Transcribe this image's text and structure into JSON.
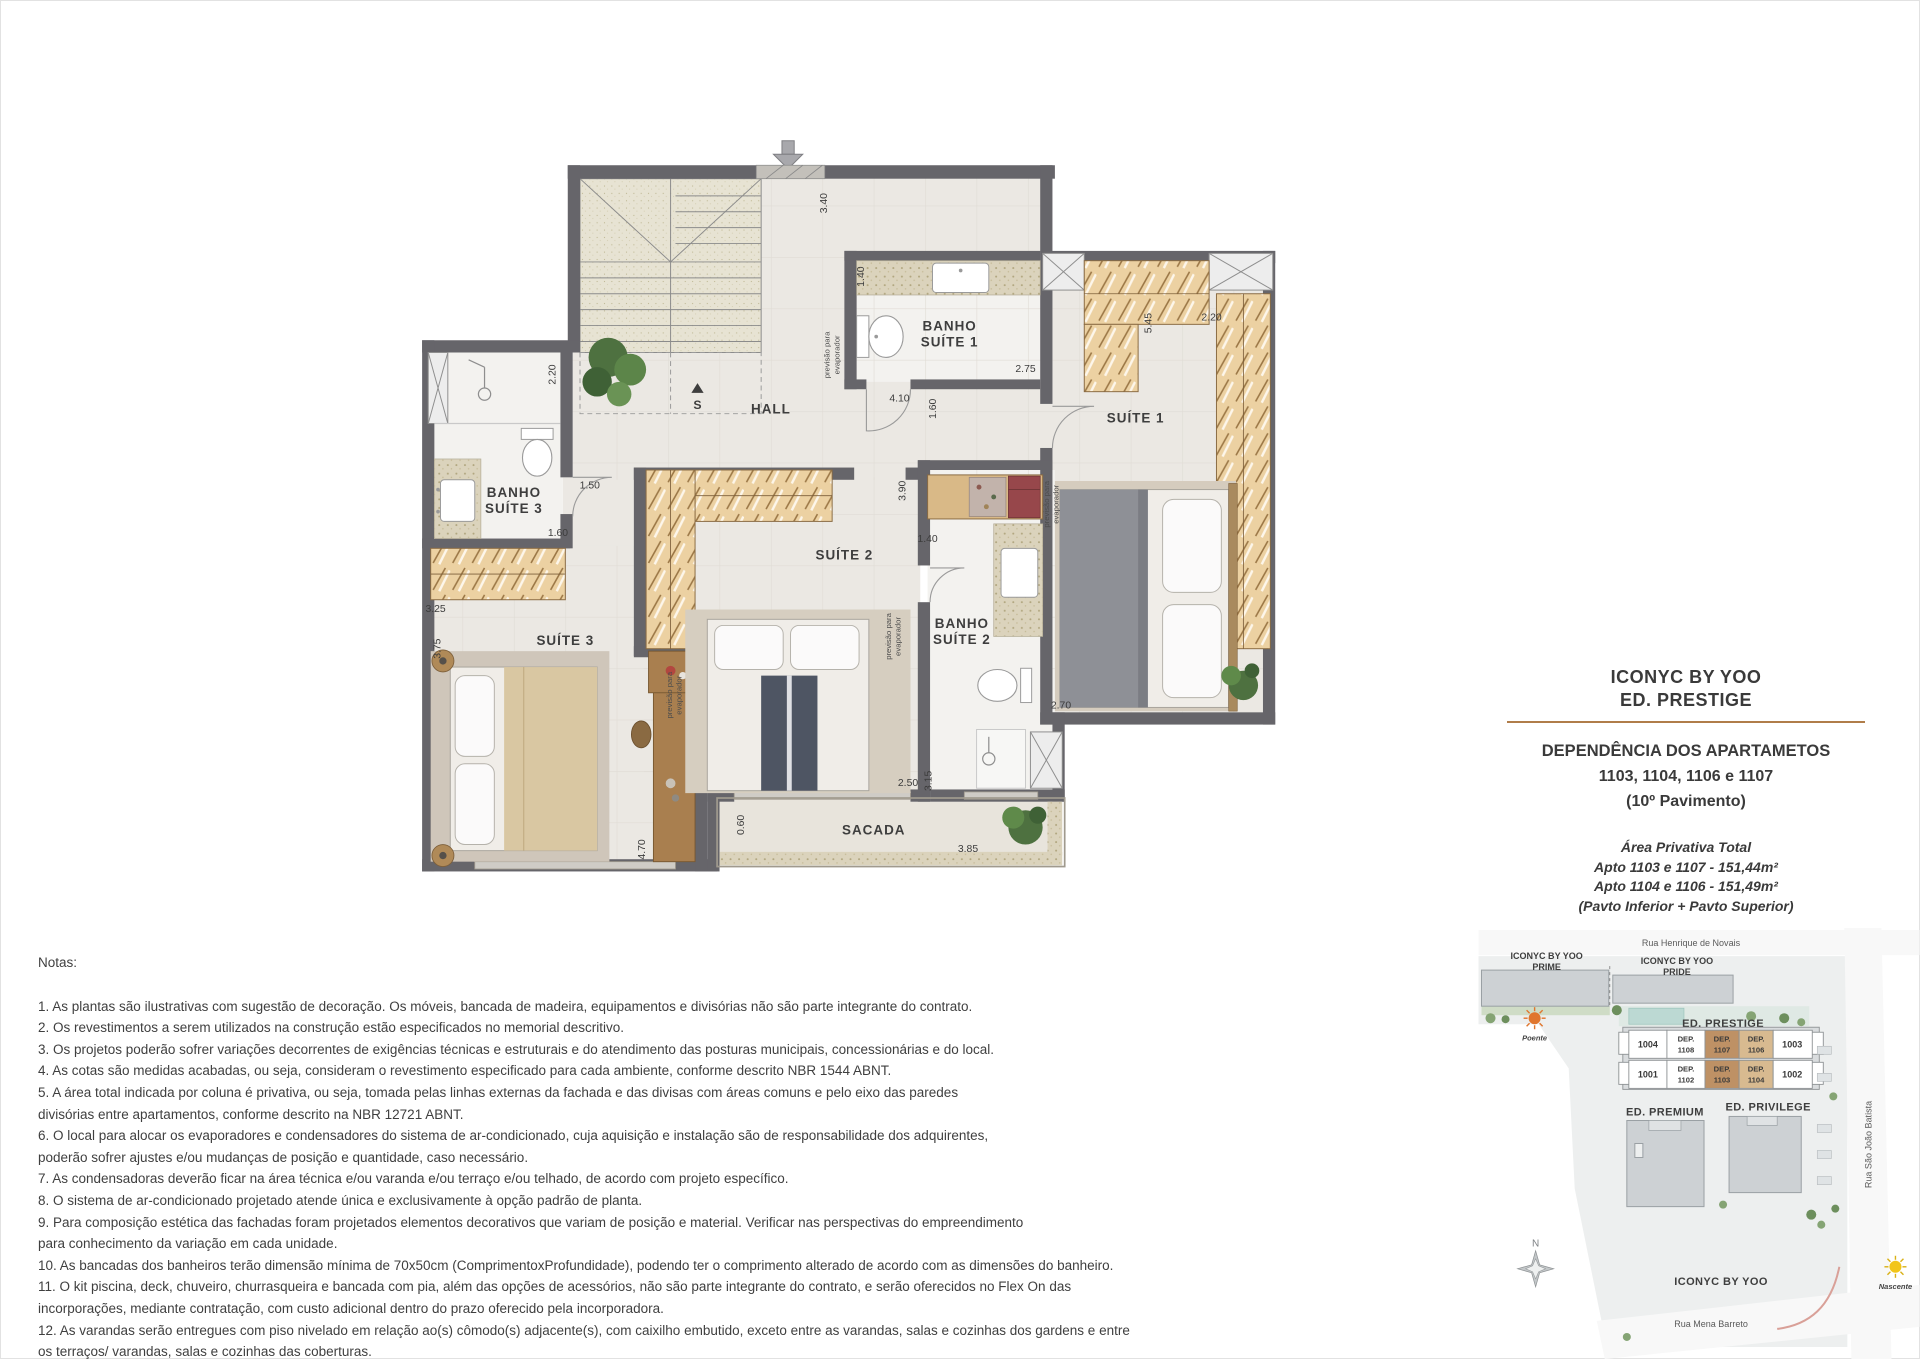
{
  "plan": {
    "rooms": {
      "hall": "HALL",
      "banho1_l1": "BANHO",
      "banho1_l2": "SUÍTE 1",
      "suite1": "SUÍTE 1",
      "banho3_l1": "BANHO",
      "banho3_l2": "SUÍTE 3",
      "suite2": "SUÍTE 2",
      "banho2_l1": "BANHO",
      "banho2_l2": "SUÍTE 2",
      "suite3": "SUÍTE 3",
      "sacada": "SACADA"
    },
    "dims": {
      "hall_340": "3.40",
      "b1_140": "1.40",
      "b1_275": "2.75",
      "s1_545": "5.45",
      "s1_220": "2.20",
      "hall_410": "4.10",
      "hall_160": "1.60",
      "b3_220": "2.20",
      "b3_150": "1.50",
      "b3_160": "1.60",
      "s3_325": "3.25",
      "s3_375": "3.75",
      "s3_470": "4.70",
      "s2_390": "3.90",
      "s2_140": "1.40",
      "s2_250": "2.50",
      "b2_270": "2.70",
      "b2_315": "3.15",
      "sac_060": "0.60",
      "sac_385": "3.85"
    },
    "stairs_marker": "S",
    "evap_l1": "previsão para",
    "evap_l2": "evaporador"
  },
  "title_block": {
    "line1": "ICONYC BY YOO",
    "line2": "ED. PRESTIGE",
    "heading1": "DEPENDÊNCIA DOS APARTAMETOS",
    "heading2": "1103, 1104, 1106 e 1107",
    "heading3": "(10º Pavimento)",
    "area_title": "Área Privativa Total",
    "area_line1": "Apto 1103 e 1107 - 151,44m²",
    "area_line2": "Apto 1104 e 1106 - 151,49m²",
    "area_line3": "(Pavto Inferior + Pavto Superior)"
  },
  "notes": {
    "title": "Notas:",
    "items": [
      "1. As plantas são ilustrativas com sugestão de decoração. Os móveis, bancada de madeira, equipamentos e divisórias não são parte integrante do contrato.",
      "2. Os revestimentos a serem utilizados na construção estão especificados no memorial descritivo.",
      "3. Os projetos poderão sofrer variações decorrentes de exigências técnicas e estruturais e do atendimento das posturas municipais, concessionárias e do local.",
      "4. As cotas são medidas acabadas, ou seja, consideram o revestimento especificado para cada ambiente, conforme descrito NBR 1544 ABNT.",
      "5. A área total indicada por coluna é privativa, ou seja, tomada pelas linhas externas da fachada e das divisas com áreas comuns e pelo eixo das paredes\ndivisórias entre apartamentos, conforme descrito na NBR 12721 ABNT.",
      "6. O local para alocar os evaporadores e condensadores do sistema de ar-condicionado, cuja aquisição e instalação são de responsabilidade dos adquirentes,\npoderão sofrer ajustes e/ou mudanças de posição e quantidade, caso necessário.",
      "7. As condensadoras deverão ficar na área técnica e/ou varanda e/ou terraço e/ou telhado, de acordo com projeto específico.",
      "8. O sistema de ar-condicionado projetado atende única e exclusivamente à opção padrão de planta.",
      "9. Para composição estética das fachadas foram projetados elementos decorativos que variam de posição e material. Verificar nas perspectivas do empreendimento\npara conhecimento da variação em cada unidade.",
      "10. As bancadas dos banheiros terão dimensão mínima de 70x50cm (ComprimentoxProfundidade), podendo ter o comprimento alterado de acordo com as dimensões do banheiro.",
      "11. O kit piscina, deck, chuveiro, churrasqueira e bancada com pia, além das opções de acessórios, não são parte integrante do contrato, e serão oferecidos no Flex On das\nincorporações, mediante contratação, com custo adicional dentro do prazo oferecido pela incorporadora.",
      "12. As varandas serão entregues com piso nivelado em relação ao(s) cômodo(s) adjacente(s), com caixilho embutido, exceto entre as varandas, salas e cozinhas dos gardens e entre\nos  terraços/ varandas, salas e cozinhas das coberturas."
    ],
    "footer": "A presente planta ilustra referencialmente a dependência dos apartamentos 1103 e 1106 do Ed. Prestige do Iconyc by Yoo, sendo a dependência dos apartamentos1104 e\n1107 do Ed. Prestige do Iconyc by Yoo espelhadas."
  },
  "site_plan": {
    "streets": {
      "north": "Rua Henrique de Novais",
      "east": "Rua São João Batista",
      "south": "Rua Mena Barreto"
    },
    "buildings": {
      "prime_l1": "ICONYC BY YOO",
      "prime_l2": "PRIME",
      "pride_l1": "ICONYC BY YOO",
      "pride_l2": "PRIDE",
      "prestige": "ED. PRESTIGE",
      "premium": "ED. PREMIUM",
      "privilege": "ED. PRIVILEGE",
      "complex": "ICONYC BY YOO"
    },
    "compass_n": "N",
    "sun_west": "Poente",
    "sun_east": "Nascente",
    "units_top": [
      {
        "l1": "1004",
        "l2": ""
      },
      {
        "l1": "DEP.",
        "l2": "1108"
      },
      {
        "l1": "DEP.",
        "l2": "1107"
      },
      {
        "l1": "DEP.",
        "l2": "1106"
      },
      {
        "l1": "1003",
        "l2": ""
      }
    ],
    "units_bottom": [
      {
        "l1": "1001",
        "l2": ""
      },
      {
        "l1": "DEP.",
        "l2": "1102"
      },
      {
        "l1": "DEP.",
        "l2": "1103"
      },
      {
        "l1": "DEP.",
        "l2": "1104"
      },
      {
        "l1": "1002",
        "l2": ""
      }
    ]
  },
  "colors": {
    "accent_rule": "#b07d4a",
    "wall": "#66656a",
    "closet_wood": "#ecd1a2",
    "unit_highlight_dark": "#be9165",
    "unit_highlight_light": "#d8ba90"
  }
}
